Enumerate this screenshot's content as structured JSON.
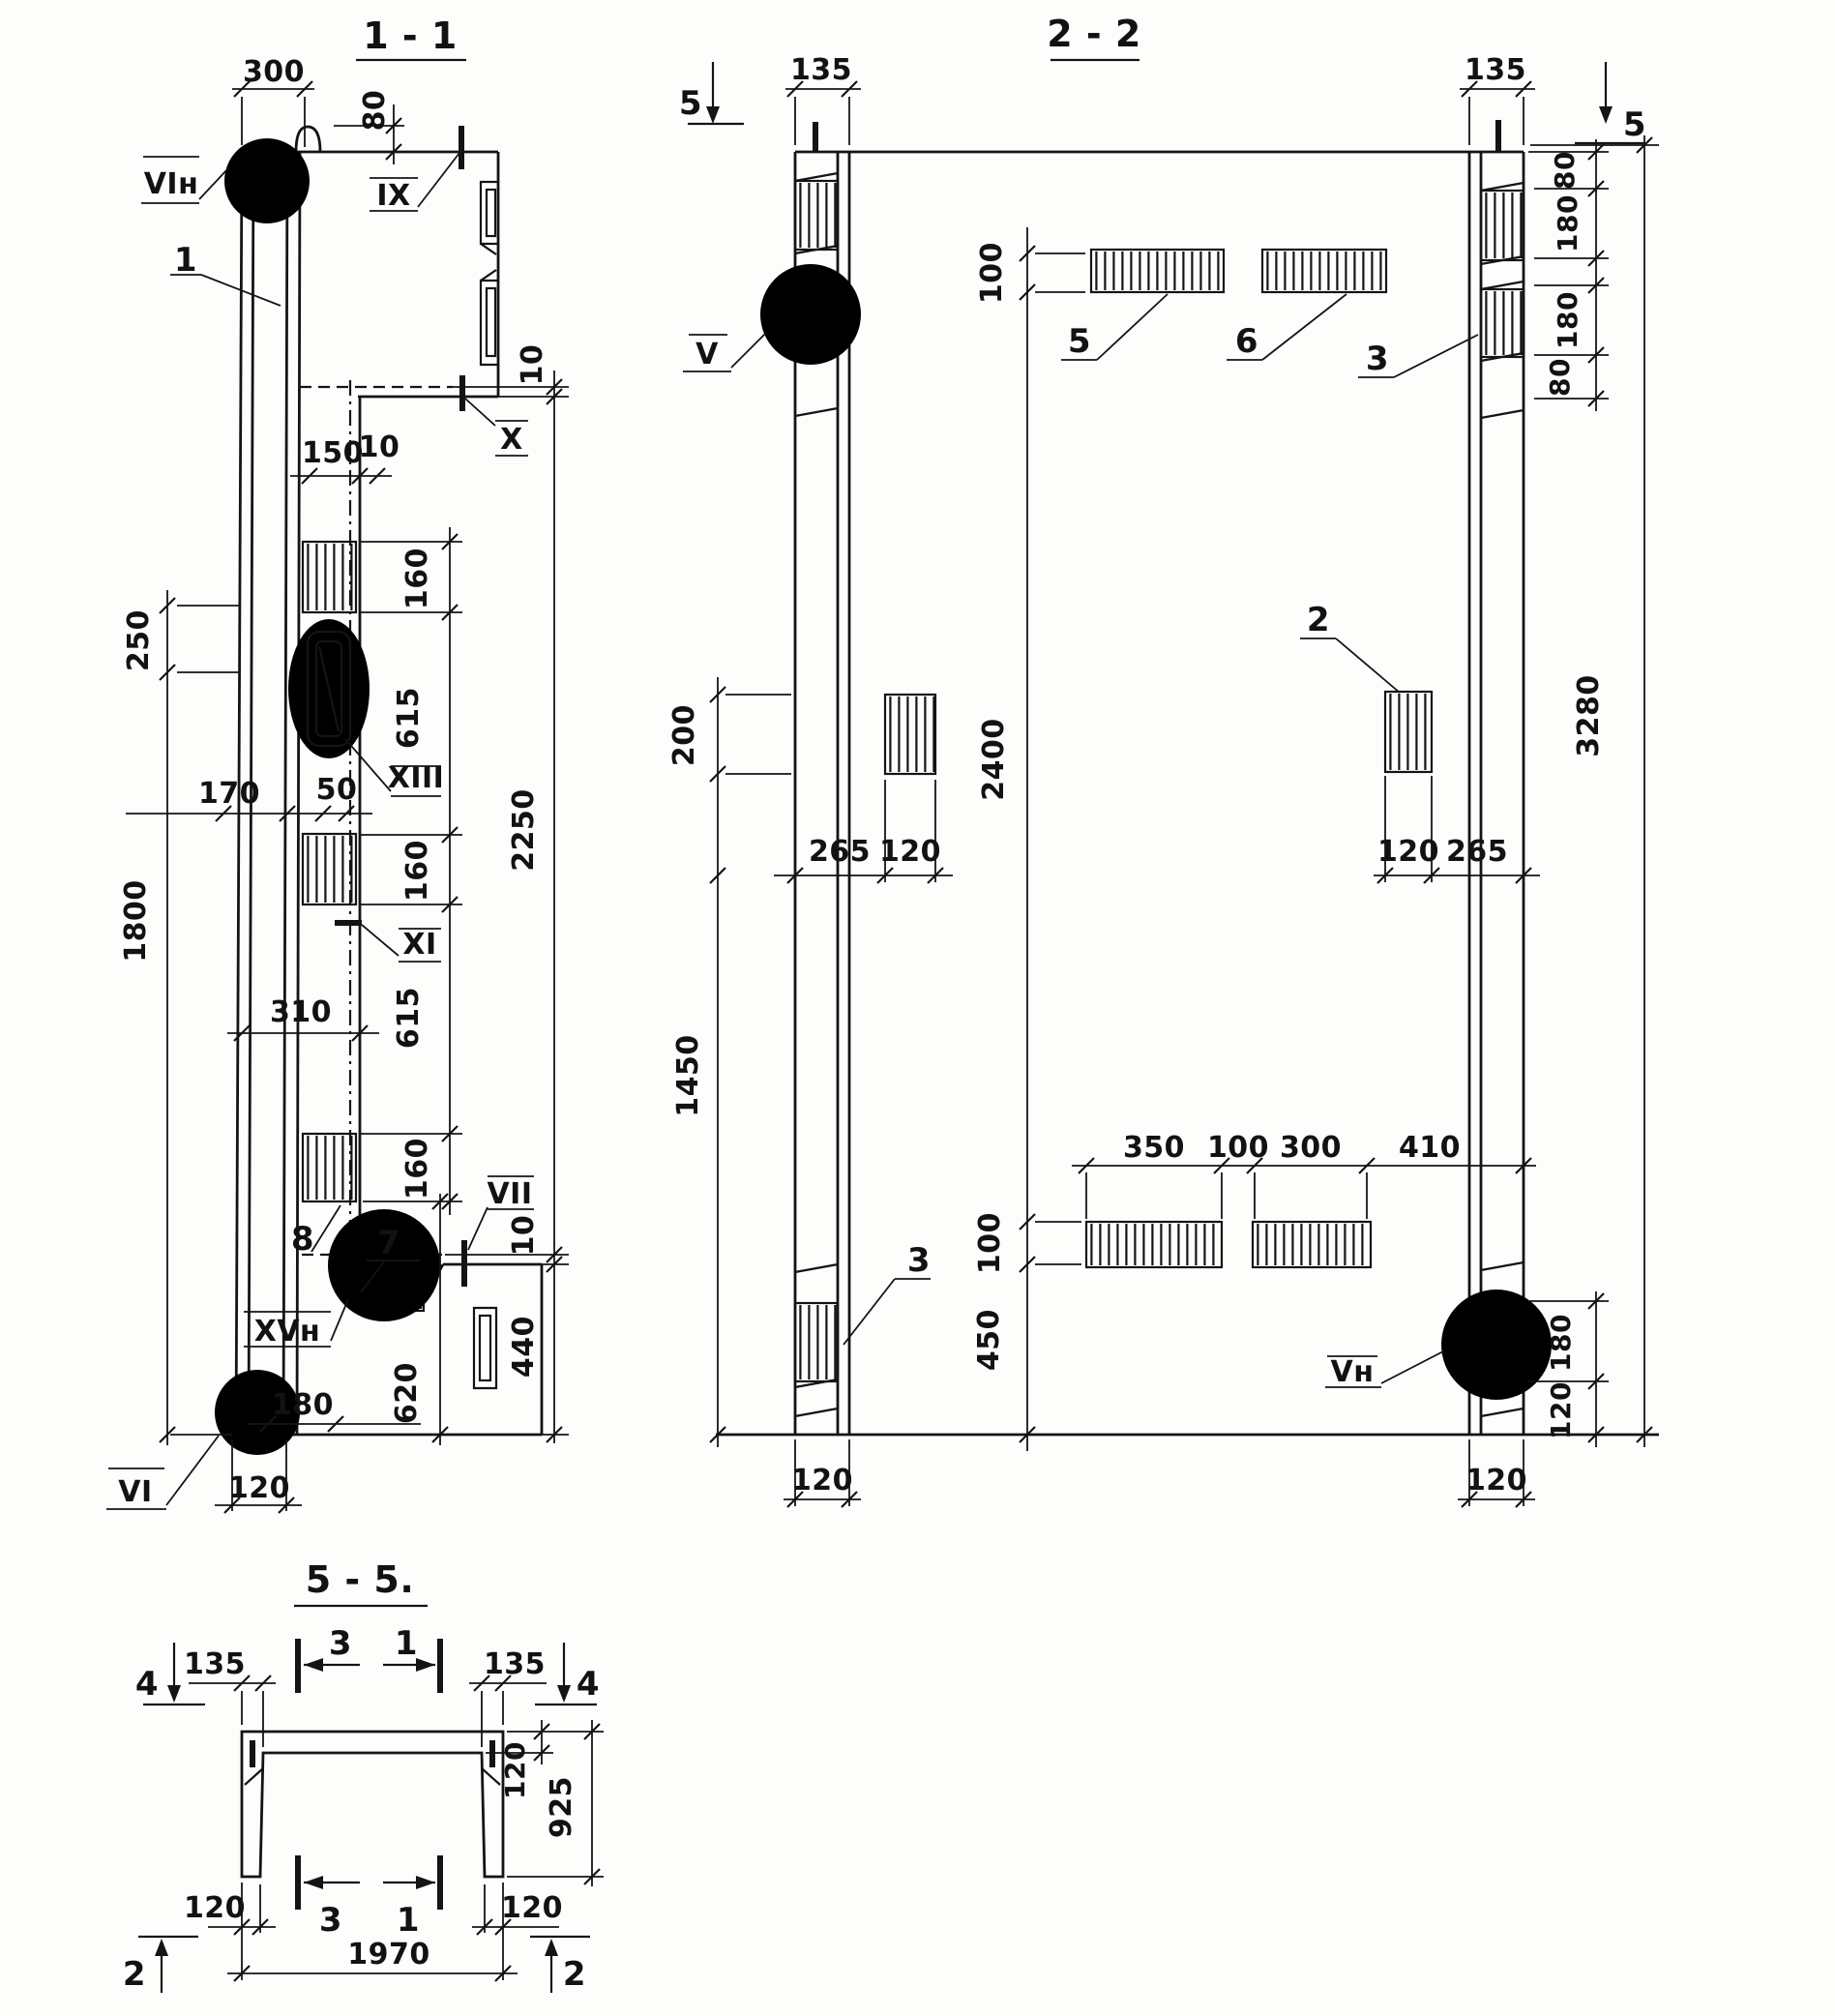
{
  "page": {
    "background": "#fdfdfc",
    "ink": "#141414"
  },
  "s11": {
    "title": "1 - 1",
    "dims": {
      "d300": "300",
      "d80": "80",
      "d10t": "10",
      "d150": "150",
      "d10m": "10",
      "d160a": "160",
      "d615a": "615",
      "d160b": "160",
      "d615b": "615",
      "d160c": "160",
      "d2250": "2250",
      "d250": "250",
      "d1800": "1800",
      "d170": "170",
      "d50": "50",
      "d310": "310",
      "d180": "180",
      "d620": "620",
      "d10b": "10",
      "d440": "440",
      "d120": "120"
    },
    "marks": {
      "vin": "VIн",
      "ix": "IX",
      "x": "X",
      "xiii": "XIII",
      "xi": "XI",
      "vii": "VII",
      "xvn": "XVн",
      "vi": "VI"
    },
    "callouts": {
      "c1": "1",
      "c7": "7",
      "c8": "8"
    }
  },
  "s22": {
    "title": "2 - 2",
    "cut_markers": {
      "left": "5",
      "right": "5"
    },
    "dims": {
      "d135l": "135",
      "d135r": "135",
      "d80a": "80",
      "d180a": "180",
      "d180b": "180",
      "d80b": "80",
      "d100t": "100",
      "d2400": "2400",
      "d100b": "100",
      "d450": "450",
      "d200": "200",
      "d265l": "265",
      "d120l": "120",
      "d120r": "120",
      "d265r": "265",
      "d3280": "3280",
      "d1450": "1450",
      "d350": "350",
      "d100m": "100",
      "d300": "300",
      "d410": "410",
      "d180c": "180",
      "d120c": "120",
      "d120ul": "120",
      "d120ur": "120"
    },
    "marks": {
      "v": "V",
      "vn": "Vн"
    },
    "callouts": {
      "c2": "2",
      "c3a": "3",
      "c3b": "3",
      "c5": "5",
      "c6": "6"
    }
  },
  "s55": {
    "title": "5 - 5.",
    "cut_markers": {
      "m4l": "4",
      "m4r": "4",
      "m3t": "3",
      "m1t": "1",
      "m3b": "3",
      "m1b": "1",
      "m2l": "2",
      "m2r": "2"
    },
    "dims": {
      "d135l": "135",
      "d135r": "135",
      "d120f": "120",
      "d925": "925",
      "d120bl": "120",
      "d120br": "120",
      "d1970": "1970"
    }
  }
}
